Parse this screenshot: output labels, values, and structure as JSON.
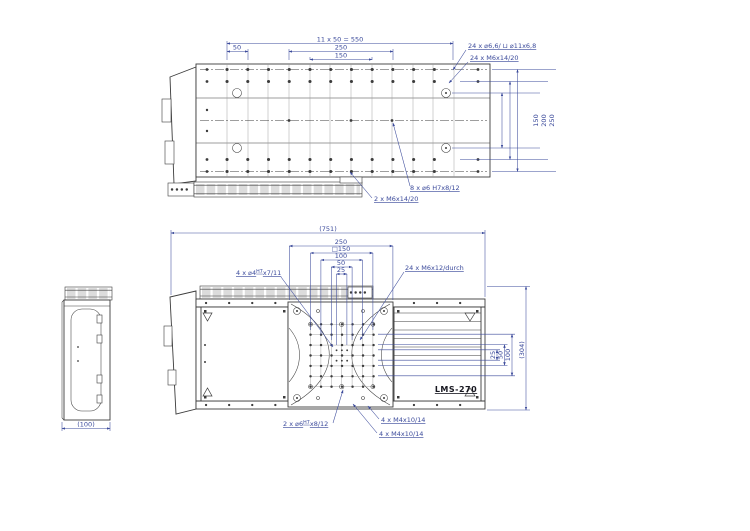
{
  "product": {
    "label": "LMS-270"
  },
  "colors": {
    "dimension": "#3b4a9b",
    "geometry": "#3c3c3c",
    "background": "#ffffff"
  },
  "views": {
    "top": {
      "dim_pitch": "11 x 50 = 550",
      "dim_250": "250",
      "dim_150": "150",
      "dim_50": "50",
      "right_dim_150": "150",
      "right_dim_200": "200",
      "right_dim_250": "250",
      "ann_counterbore": "24 x ⌀6,6/ ⊔ ⌀11x6,8",
      "ann_thread_24": "24 x M6x14/20",
      "ann_dowel_8": "8 x ⌀6 H7x8/12",
      "ann_thread_2": "2 x M6x14/20"
    },
    "plan": {
      "dim_overall_length": "(751)",
      "dim_250": "250",
      "dim_150": "□150",
      "dim_100": "100",
      "dim_50": "50",
      "dim_25": "25",
      "right_dim_25": "25",
      "right_dim_50": "50",
      "right_dim_100": "100",
      "dim_overall_width": "(304)",
      "ann_fit_4": {
        "prefix": "4 x ⌀4",
        "sup": "H7",
        "suffix": "x7/11"
      },
      "ann_thread_24": "24 x M6x12/durch",
      "ann_fit_2": {
        "prefix": "2 x ⌀6",
        "sup": "H7",
        "suffix": "x8/12"
      },
      "ann_m4_a": "4 x M4x10/14",
      "ann_m4_b": "4 x M4x10/14"
    },
    "side": {
      "dim_width": "(100)"
    }
  }
}
